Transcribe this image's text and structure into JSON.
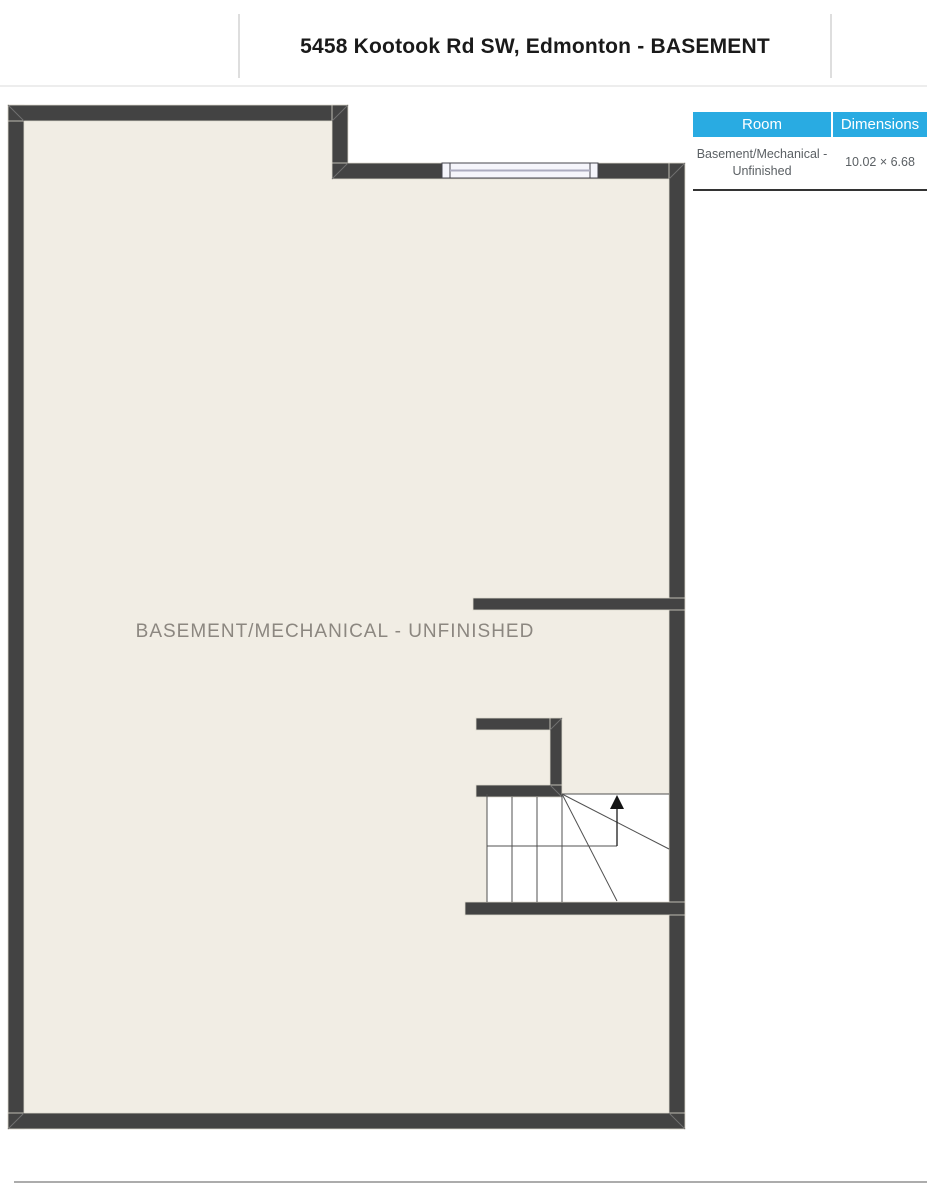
{
  "header": {
    "title": "5458 Kootook Rd SW, Edmonton - BASEMENT"
  },
  "floorplan": {
    "room_label": "BASEMENT/MECHANICAL - UNFINISHED",
    "stairs_direction": "up"
  },
  "table": {
    "columns": [
      "Room",
      "Dimensions"
    ],
    "rows": [
      {
        "room": "Basement/Mechanical - Unfinished",
        "dimensions": "10.02 × 6.68"
      }
    ]
  },
  "colors": {
    "wall": "#434343",
    "floor": "#F1EDE4",
    "accent": "#29ABE2",
    "room_label": "#8C8780"
  }
}
